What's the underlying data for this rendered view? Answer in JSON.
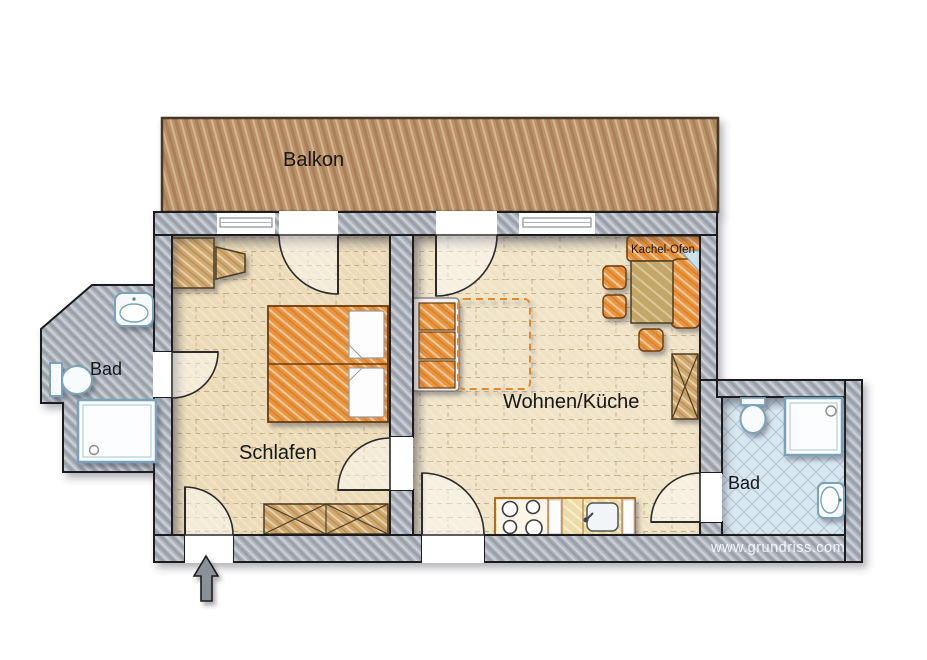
{
  "rooms": {
    "balkon": {
      "label": "Balkon"
    },
    "schlafen": {
      "label": "Schlafen"
    },
    "wohnen_kueche": {
      "label": "Wohnen/Küche"
    },
    "bad_links": {
      "label": "Bad"
    },
    "bad_rechts": {
      "label": "Bad"
    }
  },
  "annotations": {
    "kachel_ofen": "Kachel-Ofen",
    "watermark": "www.grundriss.com"
  },
  "colors": {
    "wall_gray": "#a6adb6",
    "balcony_wood": "#bb9269",
    "floor_bedroom": "#ecdbb7",
    "floor_living": "#f0e3c6",
    "bath_tile_left": "#b7d2e3",
    "bath_tile_right": "#d9e7f0",
    "furniture_orange": "#e8953f",
    "furniture_tan": "#cfa970",
    "table_olive": "#c3a768",
    "kitchen_counter": "#ecdca6",
    "fixture_outline": "#7aa2b8",
    "dashed_accent": "#e2892f"
  }
}
